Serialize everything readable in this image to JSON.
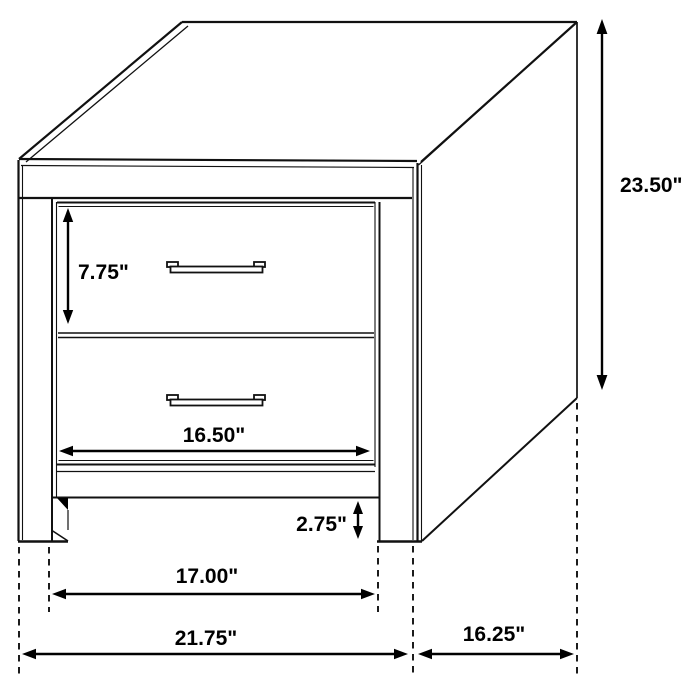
{
  "diagram": {
    "kind": "furniture-dimension-drawing",
    "subject": "two-drawer-nightstand",
    "colors": {
      "background": "#ffffff",
      "line": "#111111",
      "text": "#000000"
    },
    "labels": {
      "height": "23.50\"",
      "drawer_height": "7.75\"",
      "drawer_width": "16.50\"",
      "clearance": "2.75\"",
      "leg_span": "17.00\"",
      "overall_width": "21.75\"",
      "depth": "16.25\""
    }
  }
}
